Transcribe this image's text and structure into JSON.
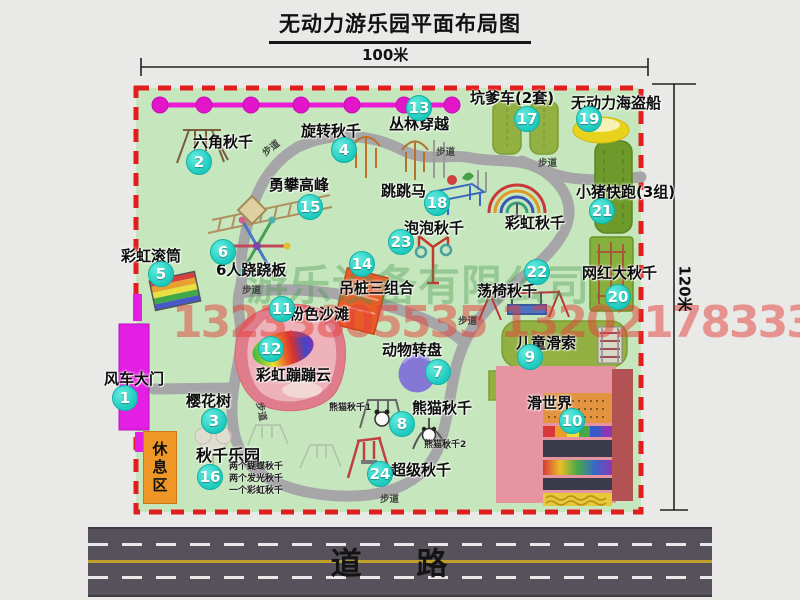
{
  "title": "无动力游乐园平面布局图",
  "dimensions": {
    "width": "100米",
    "height": "120米"
  },
  "road": {
    "label": "道 路"
  },
  "rest_area": "休息区",
  "path_label": "步道",
  "watermark": {
    "company": "游乐设备有限公司",
    "phone": "13233805535 13202178333"
  },
  "attractions": [
    {
      "num": "1",
      "name": "风车大门"
    },
    {
      "num": "2",
      "name": "六角秋千"
    },
    {
      "num": "3",
      "name": "樱花树"
    },
    {
      "num": "4",
      "name": "旋转秋千"
    },
    {
      "num": "5",
      "name": "彩虹滚筒"
    },
    {
      "num": "6",
      "name": "6人跷跷板"
    },
    {
      "num": "7",
      "name": "动物转盘"
    },
    {
      "num": "8",
      "name": "熊猫秋千"
    },
    {
      "num": "9",
      "name": "儿童滑索"
    },
    {
      "num": "10",
      "name": "滑世界"
    },
    {
      "num": "11",
      "name": "粉色沙滩"
    },
    {
      "num": "12",
      "name": "彩虹蹦蹦云"
    },
    {
      "num": "13",
      "name": "丛林穿越"
    },
    {
      "num": "14",
      "name": "吊桩三组合"
    },
    {
      "num": "15",
      "name": "勇攀高峰"
    },
    {
      "num": "16",
      "name": "秋千乐园"
    },
    {
      "num": "17",
      "name": "坑爹车(2套)"
    },
    {
      "num": "18",
      "name": "跳跳马"
    },
    {
      "num": "19",
      "name": "无动力海盗船"
    },
    {
      "num": "20",
      "name": "网红大秋千"
    },
    {
      "num": "21",
      "name": "小猪快跑(3组)"
    },
    {
      "num": "22",
      "name": "荡椅秋千"
    },
    {
      "num": "23",
      "name": "泡泡秋千"
    },
    {
      "num": "24",
      "name": "超级秋千"
    }
  ],
  "sub_labels": {
    "rainbow_swing": "彩虹秋千",
    "panda_swing_1": "熊猫秋千1",
    "panda_swing_2": "熊猫秋千2"
  },
  "swing_park_items": [
    "两个蝴蝶秋千",
    "两个发光秋千",
    "一个彩虹秋千"
  ],
  "colors": {
    "park_green": "#c6e7bd",
    "border_red": "#e21d1d",
    "badge_cyan": "#1cc9bd",
    "gate_magenta": "#e21fe2",
    "zipline_magenta": "#ec1ad8",
    "road_gray": "#56515b"
  }
}
